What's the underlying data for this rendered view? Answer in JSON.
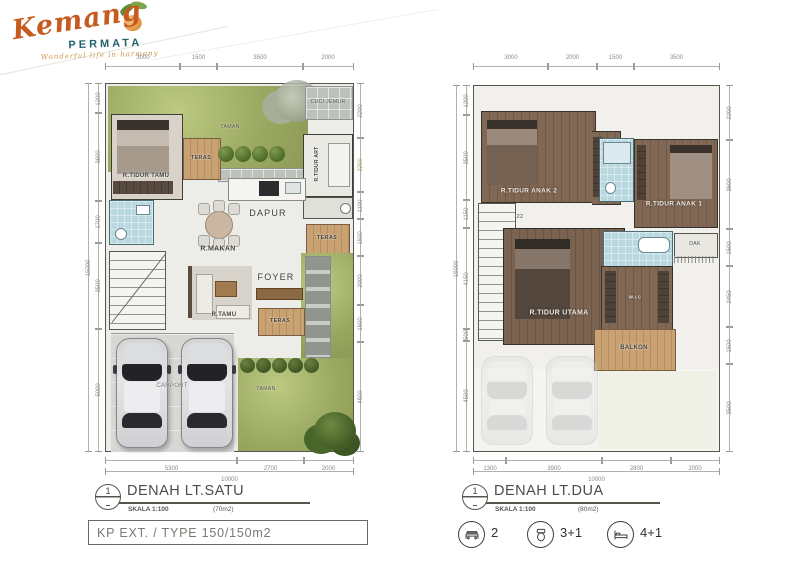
{
  "logo": {
    "name": "Kemang",
    "sub": "PERMATA",
    "tagline": "Wonderful life in harmony"
  },
  "plan1": {
    "number": "1",
    "title": "DENAH LT.SATU",
    "scale": "SKALA 1:100",
    "area": "(70m2)",
    "dims_top": [
      "3000",
      "1500",
      "3500",
      "2000"
    ],
    "dims_left": [
      "1200",
      "3600",
      "1700",
      "3500",
      "5000"
    ],
    "dims_left_total": "15000",
    "dims_right": [
      "2200",
      "2200",
      "1100",
      "1500",
      "2000",
      "1500",
      "4500"
    ],
    "dims_bottom": [
      "5300",
      "2700",
      "2000"
    ],
    "dims_bottom_total": "10000",
    "rooms": {
      "taman_top": "TAMAN",
      "cuci_jemur": "CUCI JEMUR",
      "teras_upper": "TERAS",
      "r_tidur_tamu": "R.TIDUR TAMU",
      "r_tidur_art": "R.TIDUR ART",
      "dapur": "DAPUR",
      "r_makan": "R.MAKAN",
      "teras_right": "TERAS",
      "foyer": "FOYER",
      "r_tamu": "R.TAMU",
      "teras_mid": "TERAS",
      "carport": "CARPORT",
      "taman_bottom": "TAMAN"
    }
  },
  "plan2": {
    "number": "1",
    "title": "DENAH LT.DUA",
    "scale": "SKALA 1:100",
    "area": "(80m2)",
    "dims_top": [
      "3000",
      "2000",
      "1500",
      "3500"
    ],
    "dims_left": [
      "1200",
      "3500",
      "1150",
      "4150",
      "500",
      "4500"
    ],
    "dims_left_total": "15000",
    "dims_right": [
      "2200",
      "3600",
      "1500",
      "2450",
      "1500",
      "3500"
    ],
    "dims_bottom": [
      "1300",
      "3900",
      "2800",
      "2000"
    ],
    "dims_bottom_total": "10000",
    "stair_note": "22",
    "rooms": {
      "anak2": "R.TIDUR ANAK 2",
      "anak1": "R.TIDUR ANAK 1",
      "dak": "DAK",
      "utama": "R.TIDUR UTAMA",
      "wic": "W.I.C",
      "balkon": "BALKON"
    }
  },
  "footer": {
    "type_label": "KP EXT. / TYPE 150/150m2"
  },
  "legend": {
    "cars": "2",
    "bath": "3+1",
    "bed": "4+1"
  },
  "colors": {
    "grass": "#9aa861",
    "wood": "#c59a6b",
    "wood_dark": "#70594a",
    "water": "#b9d8e0",
    "accent_orange": "#c75a1e",
    "accent_teal": "#23616e"
  }
}
